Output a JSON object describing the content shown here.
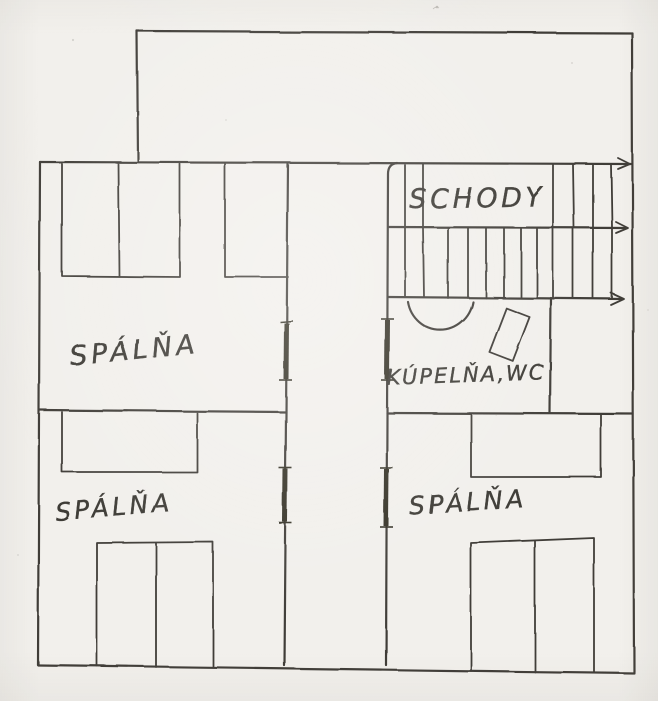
{
  "plan": {
    "title": "hand-drawn upper floor plan",
    "rooms": [
      {
        "name": "bedroom-top-left",
        "label": "SPÁLŇA"
      },
      {
        "name": "bedroom-bottom-left",
        "label": "SPÁLŇA"
      },
      {
        "name": "bedroom-right",
        "label": "SPÁLŇA"
      },
      {
        "name": "bathroom-wc",
        "label": "KÚPELŇA,WC"
      },
      {
        "name": "staircase",
        "label": "SCHODY"
      }
    ],
    "colors": {
      "ink": "#413e39",
      "paper": "#f2f0ec"
    }
  }
}
